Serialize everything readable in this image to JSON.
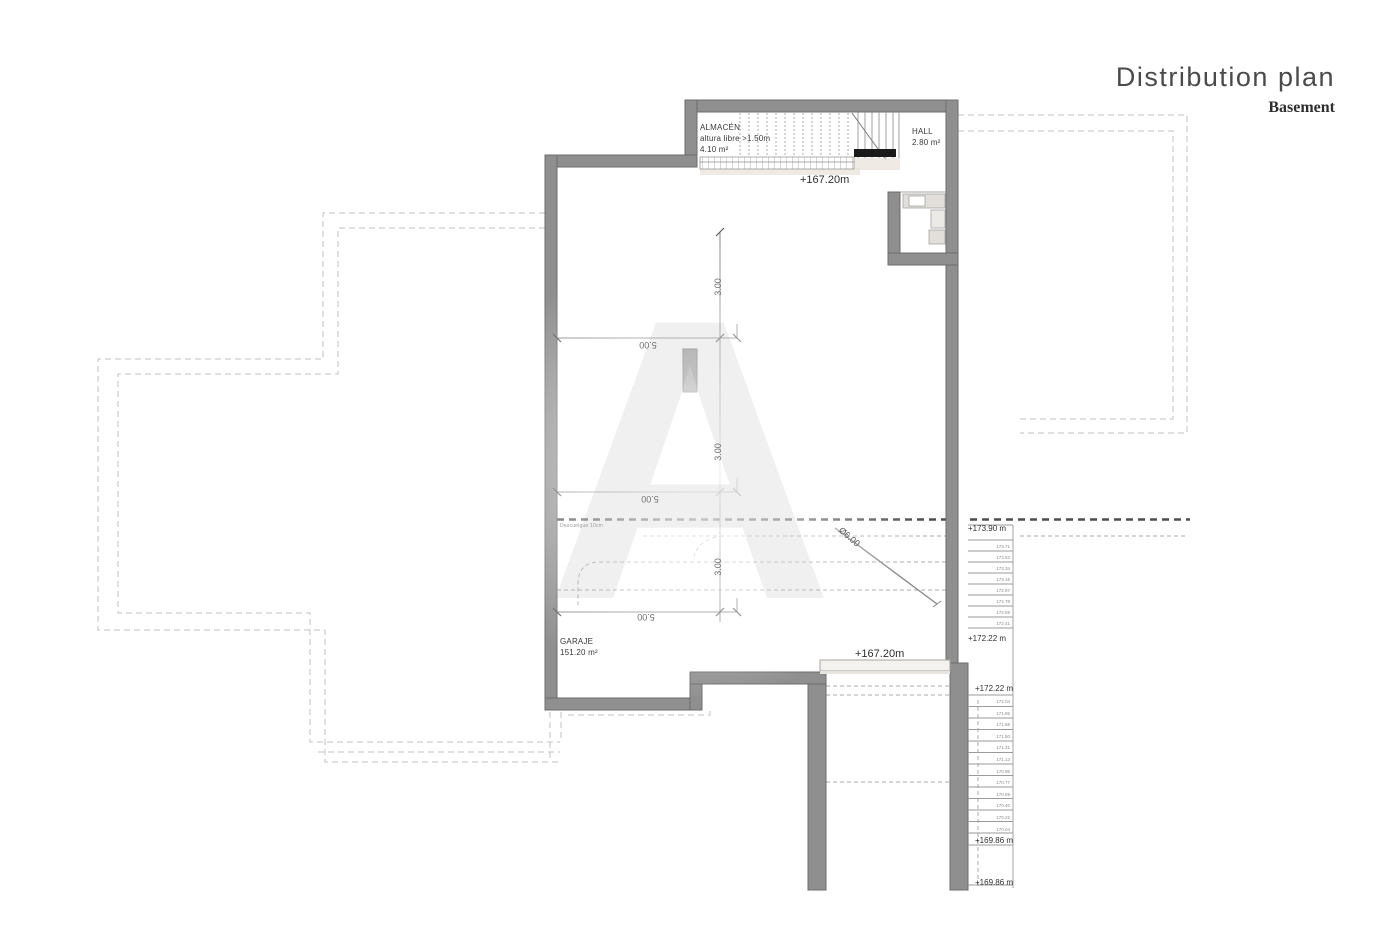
{
  "header": {
    "title": "Distribution plan",
    "subtitle": "Basement"
  },
  "rooms": {
    "almacen": {
      "name": "ALMACÉN",
      "line2": "altura libre >1.50m",
      "area": "4.10 m²"
    },
    "hall": {
      "name": "HALL",
      "area": "2.80 m²"
    },
    "garaje": {
      "name": "GARAJE",
      "area": "151.20 m²"
    }
  },
  "levels": {
    "storage_floor": "+167.20m",
    "garage_floor": "+167.20m",
    "stair_top": "+173.90 m",
    "stair_upper_landing": "+172.22 m",
    "stair_lower_start": "+172.22 m",
    "stair_lower_landing": "+169.86 m",
    "stair_bottom": "+169.86 m"
  },
  "dimensions": {
    "vertical": [
      "3.00",
      "3.00",
      "3.00"
    ],
    "horizontal": [
      "5.00",
      "5.00",
      "5.00"
    ],
    "turning_radius": "Ø6.00"
  },
  "notes": {
    "descuelgue": "Descuelgue 10cm"
  },
  "stairs": {
    "upper_values": [
      "173.71",
      "173.53",
      "173.34",
      "173.15",
      "172.97",
      "172.78",
      "172.59",
      "172.41"
    ],
    "lower_values": [
      "172.04",
      "171.86",
      "171.68",
      "171.50",
      "171.31",
      "171.13",
      "170.95",
      "170.77",
      "170.59",
      "170.40",
      "170.22",
      "170.04"
    ]
  },
  "watermark": {
    "letter": "A"
  },
  "colors": {
    "wall_fill": "#8f8f8f",
    "wall_stroke": "#6d6d6d",
    "line": "#8a8a8a",
    "boundary_dash": "#c0c0c0",
    "section_dash": "#4d4d4d",
    "text": "#3a3a3a"
  }
}
